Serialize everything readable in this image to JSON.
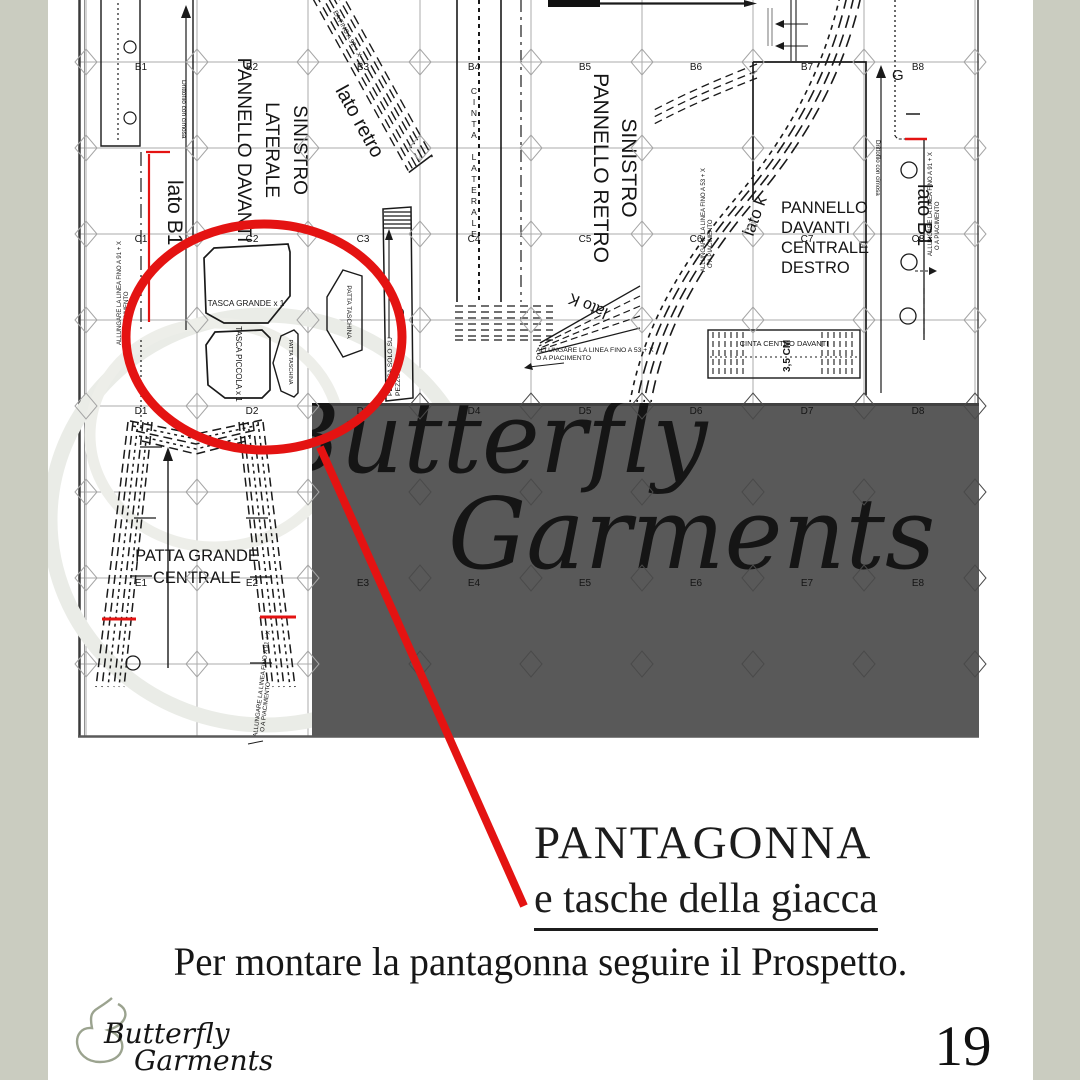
{
  "page": {
    "background_color": "#caccc0",
    "accent_red": "#e41312",
    "overlay_gray": "#595959",
    "title": "PANTAGONNA",
    "subtitle": "e tasche della giacca",
    "instruction": "Per montare la pantagonna seguire il Prospetto.",
    "page_number": "19",
    "logo": {
      "line1": "Butterfly",
      "line2": "Garments"
    },
    "watermark": {
      "line1": "Butterfly",
      "line2": "Garments"
    }
  },
  "grid": {
    "rows": [
      {
        "y": 70,
        "labels": [
          "B1",
          "B2",
          "B3",
          "B4",
          "B5",
          "B6",
          "B7",
          "B8"
        ]
      },
      {
        "y": 242,
        "labels": [
          "C1",
          "C2",
          "C3",
          "C4",
          "C5",
          "C6",
          "C7",
          "C8"
        ]
      },
      {
        "y": 414,
        "labels": [
          "D1",
          "D2",
          "D3",
          "D4",
          "D5",
          "D6",
          "D7",
          "D8"
        ]
      },
      {
        "y": 586,
        "labels": [
          "E1",
          "E2",
          "E3",
          "E4",
          "E5",
          "E6",
          "E7",
          "E8"
        ]
      }
    ]
  },
  "pieces": {
    "pannello_davanti_laterale": [
      "PANNELLO DAVANTI",
      "LATERALE",
      "SINISTRO"
    ],
    "lato_retro": "lato retro",
    "allungare_92": "EA FINO A 92 + X",
    "drittofilo_1": "Drittofilo con cimosa",
    "drittofilo_2": "Drittofilo con cimosa",
    "lato_b1_left": "lato B1",
    "lato_b1_right": "lato B1",
    "allungare_91_a": [
      "ALLUNGARE LA LINEA FINO A  91 + X",
      "O A PIACIMENTO"
    ],
    "allungare_91_b": [
      "ALLUNGARE LA LINEA FINO A  91 + X",
      "O A PIACIMENTO"
    ],
    "allungare_91_c": [
      "ALLUNGARE LA LINEA FINO A  91 + X",
      "O A PIACIMENTO"
    ],
    "allungare_53_h": [
      "ALLUNGARE LA LINEA FINO A  53 + X",
      "O A PIACIMENTO"
    ],
    "allungare_53_v": [
      "ALLUNGARE LA LINEA FINO A 53 + X",
      "O A PIACIMENTO"
    ],
    "cinta_laterale": "CINTA LATERALE",
    "pannello_retro": [
      "PANNELLO RETRO",
      "SINISTRO"
    ],
    "lato_k_upper": "lato k",
    "lato_k_lower": "lato K",
    "pannello_davanti_centrale": [
      "PANNELLO",
      "DAVANTI",
      "CENTRALE",
      "DESTRO"
    ],
    "g_label": "G",
    "placca_g": "G",
    "placca": [
      "PLACCA SOLO SU",
      "PEZZO SINIS."
    ],
    "cinta_centro": "CINTA CENTRO DAVANTI",
    "cinta_centro_size": "3,5 CM",
    "tasca_grande": "TASCA GRANDE x 1",
    "tasca_piccola": "TASCA PICCOLA x 1",
    "patta_taschina_1": "PATTA TASCHINA",
    "patta_taschina_2": "PATTA TASCHINA",
    "patta_grande": [
      "PATTA GRANDE",
      "CENTRALE"
    ]
  }
}
